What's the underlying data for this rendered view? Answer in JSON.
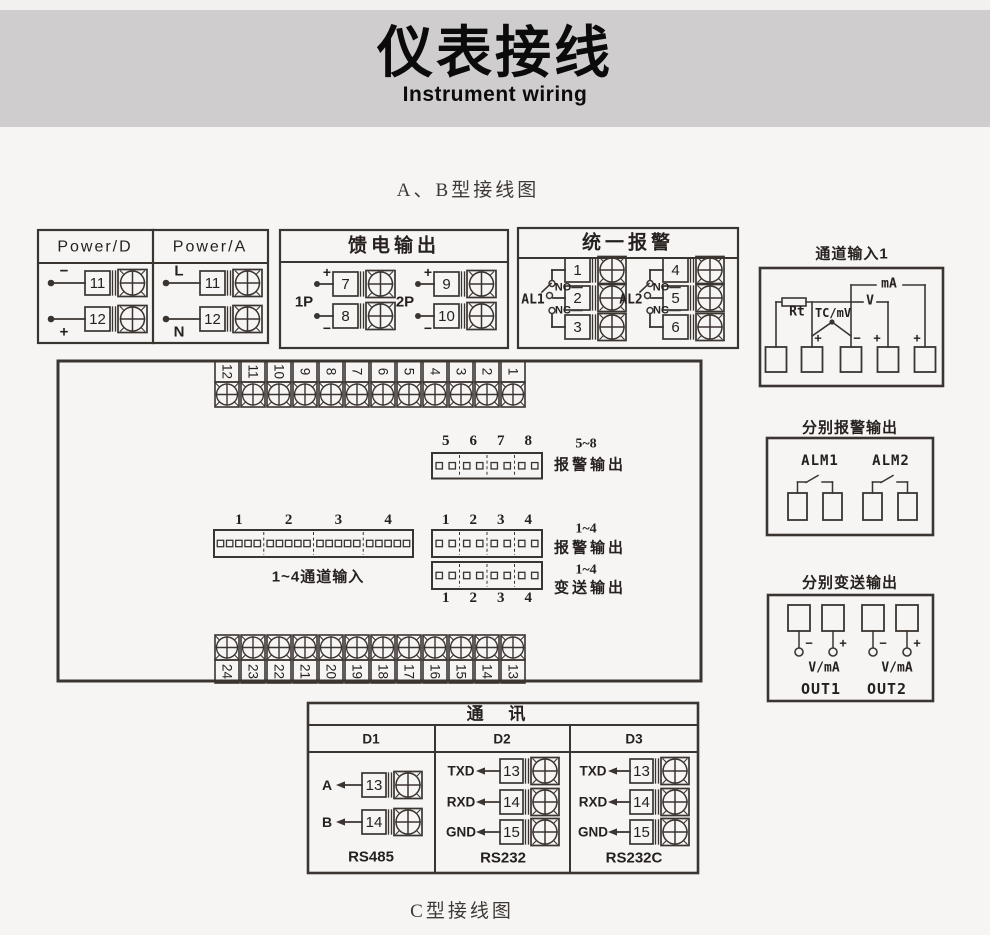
{
  "page": {
    "band_title": "仪表接线",
    "band_subtitle": "Instrument wiring",
    "section_top": "A、B型接线图",
    "section_bottom": "C型接线图"
  },
  "colors": {
    "line": "#3b3531",
    "text": "#26211e",
    "band_bg": "#cfcdce",
    "page_bg": "#f6f5f4"
  },
  "power_box": {
    "columns": [
      {
        "header": "Power/D",
        "rows": [
          {
            "sign": "−",
            "sign_pos": "above",
            "num": "11"
          },
          {
            "sign": "+",
            "sign_pos": "below",
            "num": "12"
          }
        ]
      },
      {
        "header": "Power/A",
        "rows": [
          {
            "sign": "L",
            "sign_pos": "above",
            "num": "11"
          },
          {
            "sign": "N",
            "sign_pos": "below",
            "num": "12"
          }
        ]
      }
    ]
  },
  "feed_box": {
    "header": "馈电输出",
    "groups": [
      {
        "label": "1P",
        "rows": [
          {
            "sign": "+",
            "num": "7"
          },
          {
            "sign": "−",
            "num": "8"
          }
        ]
      },
      {
        "label": "2P",
        "rows": [
          {
            "sign": "+",
            "num": "9"
          },
          {
            "sign": "−",
            "num": "10"
          }
        ]
      }
    ]
  },
  "unified_alarm_box": {
    "header": "统一报警",
    "groups": [
      {
        "label": "AL1",
        "no": "NO",
        "nc": "NC",
        "nums": [
          "1",
          "2",
          "3"
        ]
      },
      {
        "label": "AL2",
        "no": "NO",
        "nc": "NC",
        "nums": [
          "4",
          "5",
          "6"
        ]
      }
    ]
  },
  "channel_input_box": {
    "title": "通道输入1",
    "rt": "Rt",
    "tc": "TC/mV",
    "v": "V",
    "ma": "mA",
    "signs": [
      "+",
      "−",
      "+",
      "+"
    ]
  },
  "main_board": {
    "top_terminals": [
      "12",
      "11",
      "10",
      "9",
      "8",
      "7",
      "6",
      "5",
      "4",
      "3",
      "2",
      "1"
    ],
    "bottom_terminals": [
      "24",
      "23",
      "22",
      "21",
      "20",
      "19",
      "18",
      "17",
      "16",
      "15",
      "14",
      "13"
    ],
    "alarm_5_8": {
      "nums": [
        "5",
        "6",
        "7",
        "8"
      ],
      "label1": "5~8",
      "label2": "报警输出"
    },
    "channel_in": {
      "nums": [
        "1",
        "2",
        "3",
        "4"
      ],
      "label": "1~4通道输入"
    },
    "alarm_1_4": {
      "nums": [
        "1",
        "2",
        "3",
        "4"
      ],
      "label1": "1~4",
      "label2": "报警输出"
    },
    "transmit_1_4": {
      "nums": [
        "1",
        "2",
        "3",
        "4"
      ],
      "label1": "1~4",
      "label2": "变送输出"
    }
  },
  "separate_alarm_box": {
    "title": "分别报警输出",
    "channels": [
      "ALM1",
      "ALM2"
    ]
  },
  "separate_transmit_box": {
    "title": "分别变送输出",
    "minus": "−",
    "plus": "+",
    "unit": "V/mA",
    "outputs": [
      "OUT1",
      "OUT2"
    ]
  },
  "comm_box": {
    "header": "通 讯",
    "columns": [
      {
        "name": "D1",
        "rows": [
          {
            "signal": "A",
            "num": "13"
          },
          {
            "signal": "B",
            "num": "14"
          }
        ],
        "standard": "RS485"
      },
      {
        "name": "D2",
        "rows": [
          {
            "signal": "TXD",
            "num": "13"
          },
          {
            "signal": "RXD",
            "num": "14"
          },
          {
            "signal": "GND",
            "num": "15"
          }
        ],
        "standard": "RS232"
      },
      {
        "name": "D3",
        "rows": [
          {
            "signal": "TXD",
            "num": "13"
          },
          {
            "signal": "RXD",
            "num": "14"
          },
          {
            "signal": "GND",
            "num": "15"
          }
        ],
        "standard": "RS232C"
      }
    ]
  }
}
